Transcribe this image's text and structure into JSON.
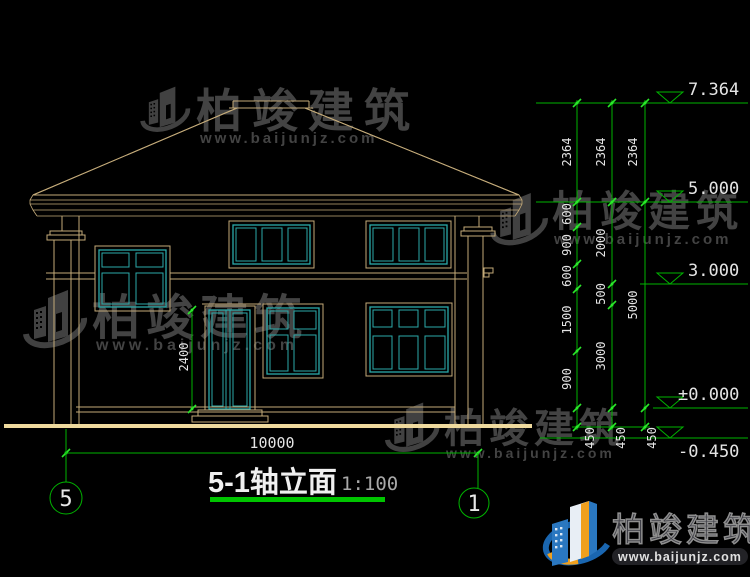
{
  "watermark": {
    "brand": "柏竣建筑",
    "url": "www.baijunjz.com"
  },
  "title": {
    "name": "5-1轴立面",
    "scale": "1:100"
  },
  "axes": {
    "left": "5",
    "right": "1"
  },
  "dims": {
    "total_width": "10000",
    "door_height": "2400",
    "col1": [
      "2364",
      "600",
      "900",
      "600",
      "1500",
      "900",
      "450"
    ],
    "col2": [
      "2364",
      "2000",
      "500",
      "3000",
      "450"
    ],
    "col3": [
      "2364",
      "5000",
      "450"
    ]
  },
  "levels": [
    "7.364",
    "5.000",
    "3.000",
    "±0.000",
    "-0.450"
  ],
  "colors": {
    "line_tan": "#c3aa79",
    "line_teal": "#2baaaa",
    "dim_green": "#00b400",
    "ground_khaki": "#efda9e",
    "logo_blue": "#2a77c0",
    "logo_orange": "#f0a01e"
  }
}
